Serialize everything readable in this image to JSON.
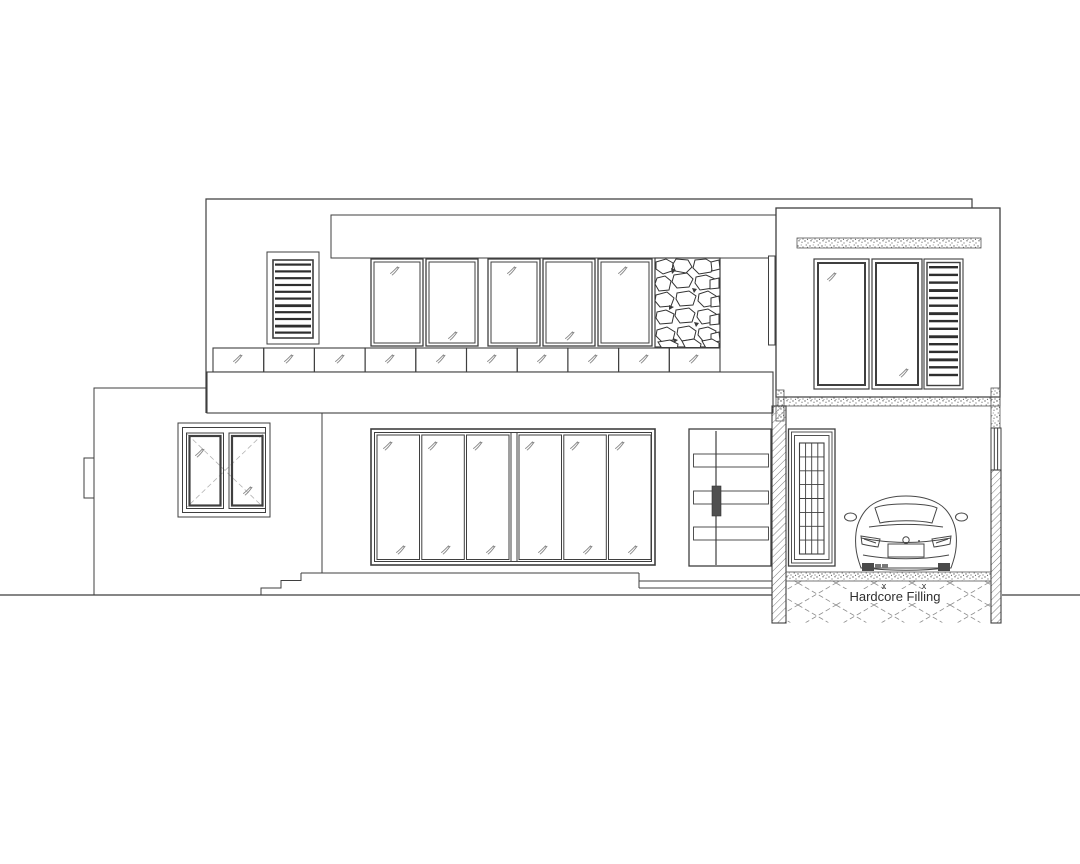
{
  "palette": {
    "background": "#ffffff",
    "line": "#3f3f3f",
    "light_line": "#8a8a8a",
    "dark_fill": "#2e2e2e",
    "speckle": "#666666"
  },
  "annotations": {
    "hardcore_filling": "Hardcore Filling",
    "x_mark": "x"
  },
  "elevation": {
    "left_wing": {
      "window_casements": 2
    },
    "main_block": {
      "upper_windows": 5,
      "louver_slats": 11,
      "balcony_rail_panels": 10,
      "stone_cladding": "rubble-stone-panel"
    },
    "ground_floor": {
      "window_panes": 6,
      "door_leaves": 2,
      "door_recessed_panels": 3,
      "steps_left": 3,
      "steps_right": 3
    },
    "right_block": {
      "windows": 2,
      "louver_slats": 15
    },
    "garage": {
      "glazed_door_grid": "4x8",
      "vehicle": "sports-car-rear-view"
    }
  }
}
